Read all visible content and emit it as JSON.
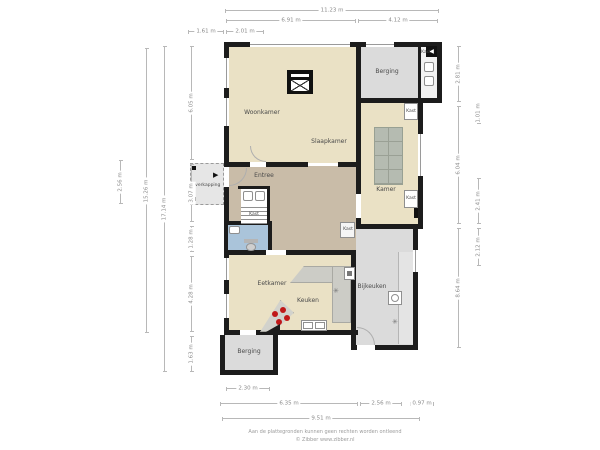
{
  "plan": {
    "disclaimer_line1": "Aan de plattegronden kunnen geen rechten worden ontleend",
    "disclaimer_line2": "© Zibber www.zibber.nl",
    "entrance_arrow": "◀",
    "door_arrow": "▶",
    "vent_symbol": "✳"
  },
  "colors": {
    "wall": "#1c1c1c",
    "living_floor": "#eae1c5",
    "hall_floor": "#c9bca8",
    "storage_floor": "#dbdbdb",
    "wc_floor": "#aac4da",
    "dim_text": "#8a8a8a"
  },
  "rooms": [
    {
      "id": "woonkamer",
      "label": "Woonkamer",
      "x": 262,
      "y": 113,
      "size": 6
    },
    {
      "id": "slaapkamer",
      "label": "Slaapkamer",
      "x": 329,
      "y": 142,
      "size": 6
    },
    {
      "id": "berging-top",
      "label": "Berging",
      "x": 387,
      "y": 72,
      "size": 6
    },
    {
      "id": "kast-top",
      "label": "Kast",
      "x": 426,
      "y": 53,
      "size": 4.5
    },
    {
      "id": "kamer",
      "label": "Kamer",
      "x": 386,
      "y": 190,
      "size": 6
    },
    {
      "id": "kast-kamer-top",
      "label": "Kast",
      "x": 411,
      "y": 112,
      "size": 4.5
    },
    {
      "id": "kast-kamer-bottom",
      "label": "Kast",
      "x": 411,
      "y": 199,
      "size": 4.5
    },
    {
      "id": "entree",
      "label": "Entree",
      "x": 264,
      "y": 176,
      "size": 6
    },
    {
      "id": "overkapping",
      "label": "Overkapping",
      "x": 206,
      "y": 186,
      "size": 4.5
    },
    {
      "id": "kast-stairs",
      "label": "Kast",
      "x": 254,
      "y": 215,
      "size": 4.5
    },
    {
      "id": "eetkamer",
      "label": "Eetkamer",
      "x": 272,
      "y": 284,
      "size": 6
    },
    {
      "id": "keuken",
      "label": "Keuken",
      "x": 308,
      "y": 301,
      "size": 6
    },
    {
      "id": "bijkeuken",
      "label": "Bijkeuken",
      "x": 372,
      "y": 287,
      "size": 6
    },
    {
      "id": "kast-bijkeuken",
      "label": "Kast",
      "x": 348,
      "y": 230,
      "size": 4.5
    },
    {
      "id": "berging-bottom",
      "label": "Berging",
      "x": 249,
      "y": 352,
      "size": 6
    }
  ],
  "dimensions": [
    {
      "id": "top-total",
      "label": "11.23 m",
      "dir": "h",
      "x": 225,
      "y": 10,
      "len": 214
    },
    {
      "id": "top-left-span",
      "label": "6.91 m",
      "dir": "h",
      "x": 226,
      "y": 20,
      "len": 130
    },
    {
      "id": "top-right-span",
      "label": "4.12 m",
      "dir": "h",
      "x": 358,
      "y": 20,
      "len": 80
    },
    {
      "id": "top-overkapping",
      "label": "1.61 m",
      "dir": "h",
      "x": 188,
      "y": 31,
      "len": 36
    },
    {
      "id": "top-small",
      "label": "2.01 m",
      "dir": "h",
      "x": 226,
      "y": 31,
      "len": 38
    },
    {
      "id": "bottom-berging",
      "label": "2.30 m",
      "dir": "h",
      "x": 226,
      "y": 388,
      "len": 44
    },
    {
      "id": "bottom-left-span",
      "label": "6.35 m",
      "dir": "h",
      "x": 220,
      "y": 403,
      "len": 138
    },
    {
      "id": "bottom-mid-span",
      "label": "2.56 m",
      "dir": "h",
      "x": 360,
      "y": 403,
      "len": 42
    },
    {
      "id": "bottom-small",
      "label": "0.97 m",
      "dir": "h",
      "x": 410,
      "y": 403,
      "len": 24
    },
    {
      "id": "bottom-total",
      "label": "9.51 m",
      "dir": "h",
      "x": 222,
      "y": 418,
      "len": 198
    },
    {
      "id": "left-overkapping",
      "label": "2.56 m",
      "dir": "v",
      "x": 120,
      "y": 160,
      "len": 44
    },
    {
      "id": "left-inner-total",
      "label": "15.26 m",
      "dir": "v",
      "x": 146,
      "y": 48,
      "len": 285
    },
    {
      "id": "left-total",
      "label": "17.14 m",
      "dir": "v",
      "x": 164,
      "y": 46,
      "len": 326
    },
    {
      "id": "left-seg-1",
      "label": "6.05 m",
      "dir": "v",
      "x": 191,
      "y": 46,
      "len": 114
    },
    {
      "id": "left-seg-2",
      "label": "3.07 m",
      "dir": "v",
      "x": 191,
      "y": 164,
      "len": 58
    },
    {
      "id": "left-seg-3",
      "label": "1.28 m",
      "dir": "v",
      "x": 191,
      "y": 226,
      "len": 26
    },
    {
      "id": "left-seg-4",
      "label": "4.28 m",
      "dir": "v",
      "x": 191,
      "y": 256,
      "len": 76
    },
    {
      "id": "left-seg-5",
      "label": "1.63 m",
      "dir": "v",
      "x": 191,
      "y": 336,
      "len": 36
    },
    {
      "id": "right-seg-1",
      "label": "2.81 m",
      "dir": "v",
      "x": 458,
      "y": 46,
      "len": 56
    },
    {
      "id": "right-seg-2",
      "label": "6.04 m",
      "dir": "v",
      "x": 458,
      "y": 106,
      "len": 118
    },
    {
      "id": "right-seg-3",
      "label": "8.64 m",
      "dir": "v",
      "x": 458,
      "y": 228,
      "len": 120
    },
    {
      "id": "right-out-1",
      "label": "1.01 m",
      "dir": "v",
      "x": 478,
      "y": 102,
      "len": 22
    },
    {
      "id": "right-out-2",
      "label": "2.41 m",
      "dir": "v",
      "x": 478,
      "y": 178,
      "len": 46
    },
    {
      "id": "right-out-3",
      "label": "2.12 m",
      "dir": "v",
      "x": 478,
      "y": 228,
      "len": 38
    }
  ]
}
